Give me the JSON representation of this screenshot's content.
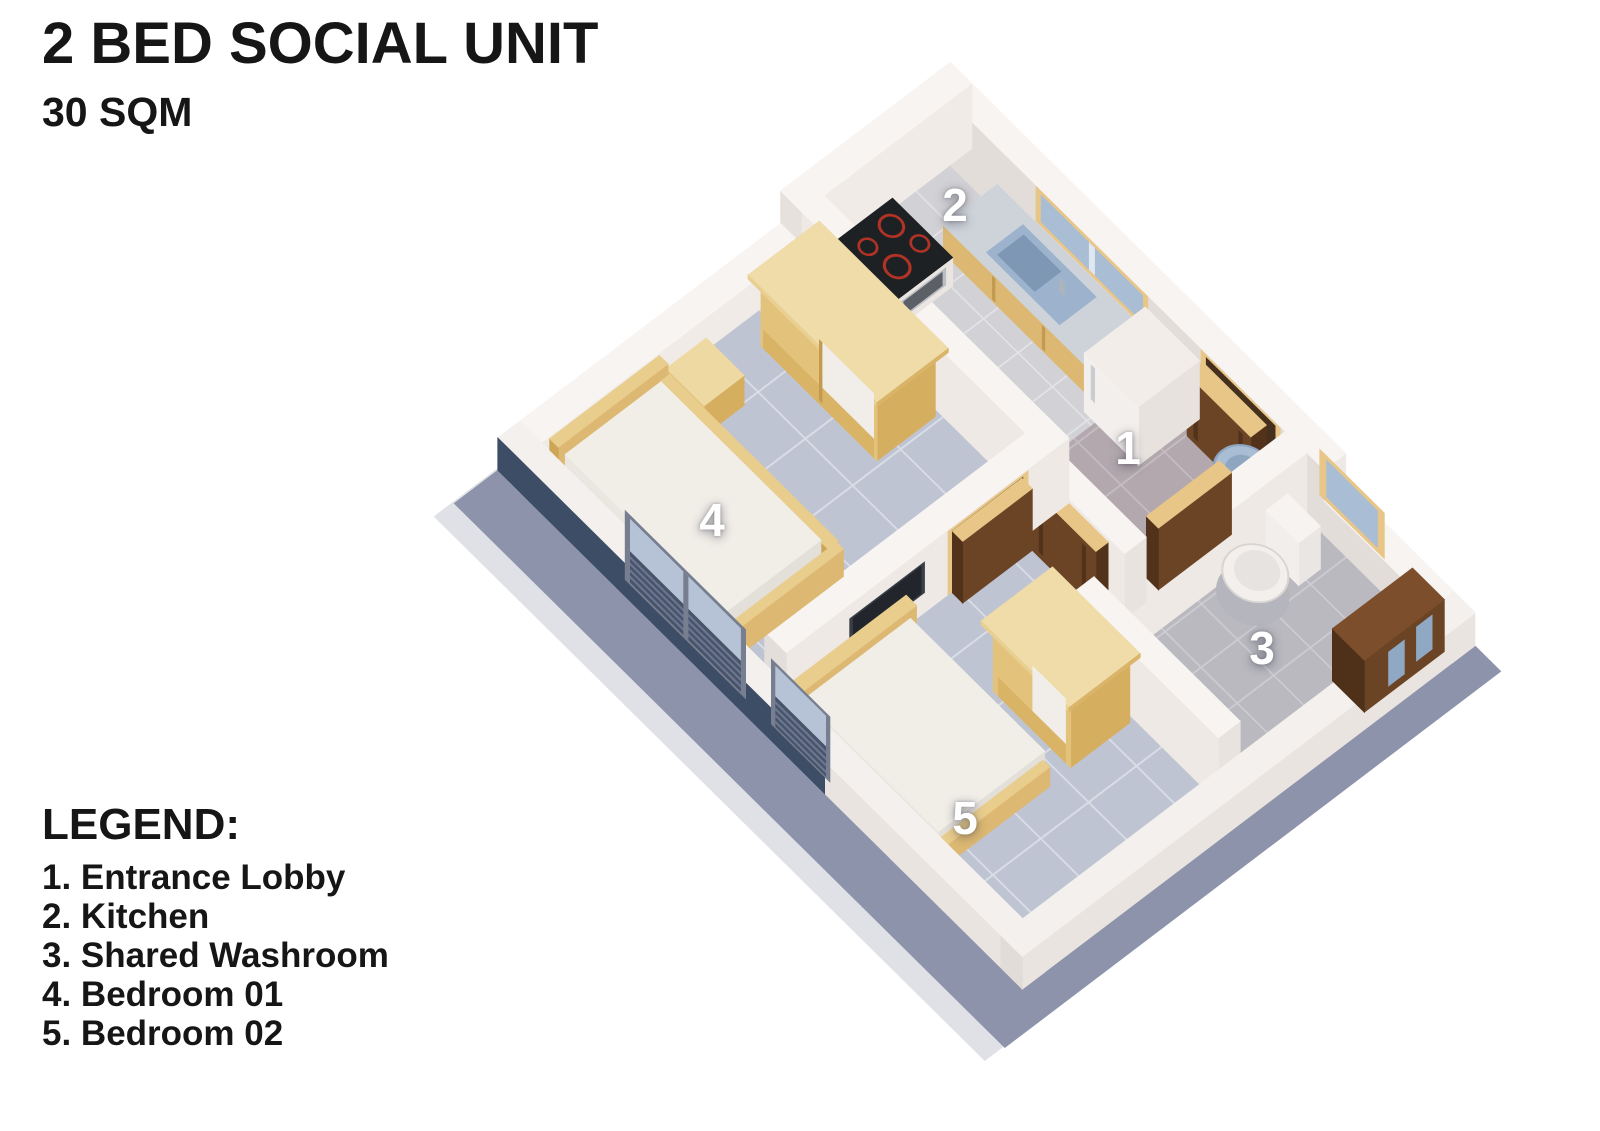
{
  "title": "2 BED SOCIAL UNIT",
  "subtitle": "30 SQM",
  "legend": {
    "heading": "LEGEND:",
    "items": [
      "1. Entrance Lobby",
      "2. Kitchen",
      "3. Shared Washroom",
      "4. Bedroom 01",
      "5. Bedroom 02"
    ]
  },
  "plan": {
    "labels": {
      "entrance_lobby": "1",
      "kitchen": "2",
      "shared_washroom": "3",
      "bedroom_01": "4",
      "bedroom_02": "5"
    }
  },
  "colors": {
    "text": "#161616",
    "room_label_text": "#ffffff",
    "accent_wall_navy": "#3d4d66",
    "wall_white": "#f2eeea",
    "base_slab": "#8d93ab",
    "floor_tile_bedroom": "#bfc4d3",
    "floor_tile_kitchen": "#d2d2d6",
    "floor_tile_lobby": "#b2a8ae",
    "floor_tile_washroom": "#b9b9bf",
    "wood_pine": "#dcb873",
    "wood_walnut": "#6b4425",
    "window_glass": "#a9bdd4",
    "stove_ring_red": "#b23226"
  }
}
